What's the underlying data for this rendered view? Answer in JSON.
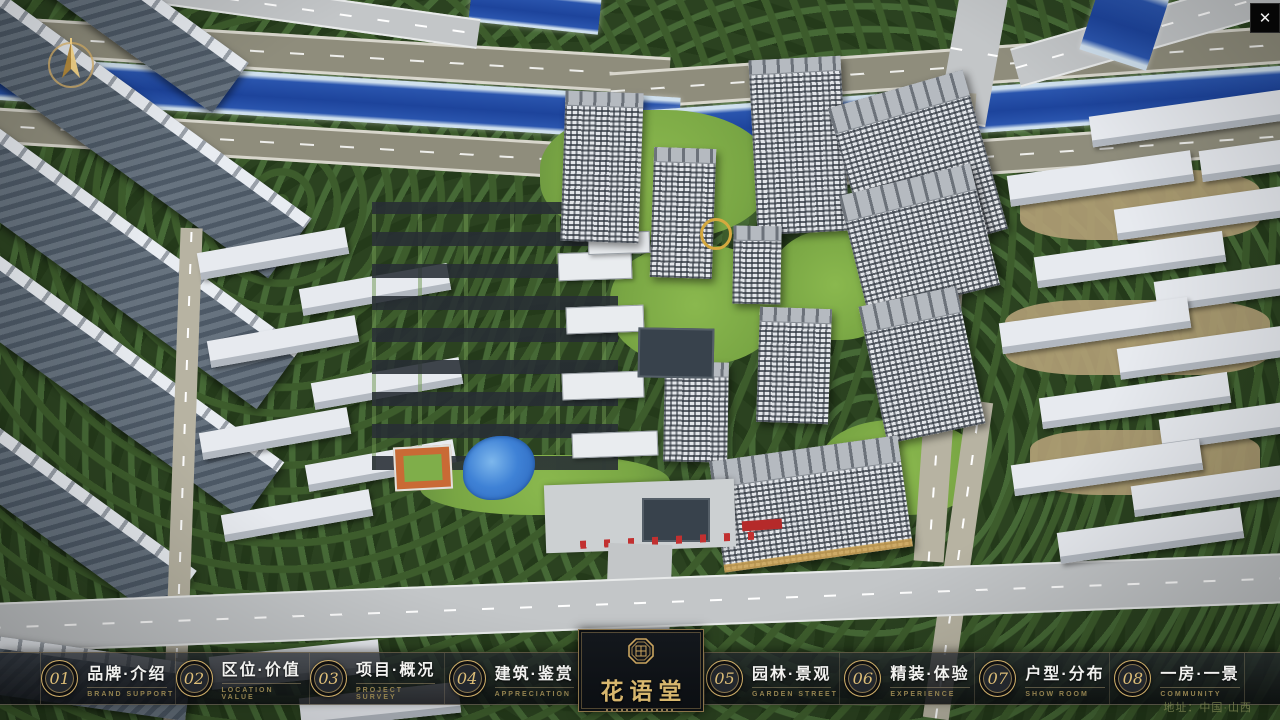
{
  "ui": {
    "accent_gold": "#c9a86a",
    "bar_bg": "#14171c",
    "river_blue": "#1d449c",
    "close_glyph": "✕"
  },
  "logo": {
    "title": "花语堂"
  },
  "nav": {
    "items": [
      {
        "num": "01",
        "zh": "品牌·介绍",
        "en": "BRAND SUPPORT"
      },
      {
        "num": "02",
        "zh": "区位·价值",
        "en": "LOCATION VALUE"
      },
      {
        "num": "03",
        "zh": "项目·概况",
        "en": "PROJECT SURVEY"
      },
      {
        "num": "04",
        "zh": "建筑·鉴赏",
        "en": "APPRECIATION"
      },
      {
        "num": "05",
        "zh": "园林·景观",
        "en": "GARDEN STREET"
      },
      {
        "num": "06",
        "zh": "精装·体验",
        "en": "EXPERIENCE"
      },
      {
        "num": "07",
        "zh": "户型·分布",
        "en": "SHOW ROOM"
      },
      {
        "num": "08",
        "zh": "一房·一景",
        "en": "COMMUNITY"
      }
    ]
  },
  "footer": {
    "address": "地址：中国·山西"
  }
}
